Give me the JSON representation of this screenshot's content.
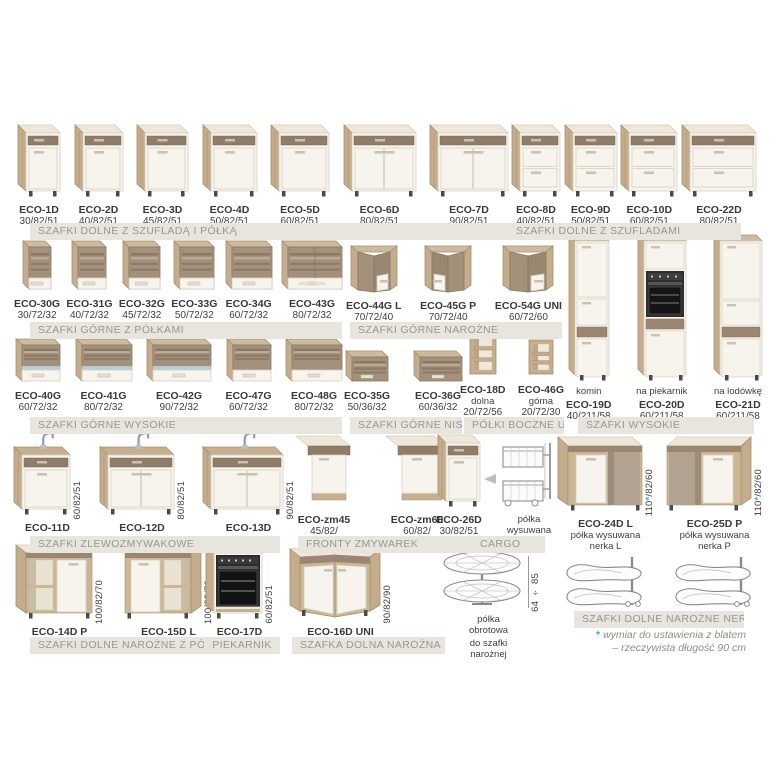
{
  "palette": {
    "wood": "#c4ad8c",
    "wood_dark": "#a68e6d",
    "rustic_front": "#a3917c",
    "white_front": "#f7f4ee",
    "counter": "#efe8da",
    "dark_strip": "#8f7c69",
    "bar_bg": "#e8e5df",
    "bar_text": "#98968e",
    "accent_blue": "#2fa8d5",
    "text": "#3a3a3a",
    "taupe": "#b2a292",
    "glass": "#b9cdd6"
  },
  "sections": [
    {
      "label": "SZAFKI DOLNE Z SZUFLADĄ I PÓŁKĄ",
      "products": [
        {
          "name": "ECO-1D",
          "dims": "30/82/51"
        },
        {
          "name": "ECO-2D",
          "dims": "40/82/51"
        },
        {
          "name": "ECO-3D",
          "dims": "45/82/51"
        },
        {
          "name": "ECO-4D",
          "dims": "50/82/51"
        },
        {
          "name": "ECO-5D",
          "dims": "60/82/51"
        },
        {
          "name": "ECO-6D",
          "dims": "80/82/51"
        },
        {
          "name": "ECO-7D",
          "dims": "90/82/51"
        }
      ]
    },
    {
      "label": "SZAFKI DOLNE Z SZUFLADAMI",
      "products": [
        {
          "name": "ECO-8D",
          "dims": "40/82/51"
        },
        {
          "name": "ECO-9D",
          "dims": "50/82/51"
        },
        {
          "name": "ECO-10D",
          "dims": "60/82/51"
        },
        {
          "name": "ECO-22D",
          "dims": "80/82/51"
        }
      ]
    },
    {
      "label": "SZAFKI GÓRNE Z PÓŁKAMI",
      "products": [
        {
          "name": "ECO-30G",
          "dims": "30/72/32"
        },
        {
          "name": "ECO-31G",
          "dims": "40/72/32"
        },
        {
          "name": "ECO-32G",
          "dims": "45/72/32"
        },
        {
          "name": "ECO-33G",
          "dims": "50/72/32"
        },
        {
          "name": "ECO-34G",
          "dims": "60/72/32"
        },
        {
          "name": "ECO-43G",
          "dims": "80/72/32"
        }
      ]
    },
    {
      "label": "SZAFKI GÓRNE NAROŻNE",
      "products": [
        {
          "name": "ECO-44G L",
          "dims": "70/72/40"
        },
        {
          "name": "ECO-45G P",
          "dims": "70/72/40"
        },
        {
          "name": "ECO-54G UNI",
          "dims": "60/72/60"
        }
      ]
    },
    {
      "label": "SZAFKI WYSOKIE",
      "products": [
        {
          "name": "ECO-19D",
          "dims": "40/211/58",
          "note": "komin"
        },
        {
          "name": "ECO-20D",
          "dims": "60/211/58",
          "note": "na piekarnik"
        },
        {
          "name": "ECO-21D",
          "dims": "60/211/58",
          "note": "na lodówkę"
        }
      ]
    },
    {
      "label": "SZAFKI GÓRNE WYSOKIE",
      "products": [
        {
          "name": "ECO-40G",
          "dims": "60/72/32"
        },
        {
          "name": "ECO-41G",
          "dims": "80/72/32"
        },
        {
          "name": "ECO-42G",
          "dims": "90/72/32"
        },
        {
          "name": "ECO-47G",
          "dims": "60/72/32"
        },
        {
          "name": "ECO-48G",
          "dims": "80/72/32"
        }
      ]
    },
    {
      "label": "SZAFKI GÓRNE NISKIE",
      "products": [
        {
          "name": "ECO-35G",
          "dims": "50/36/32"
        },
        {
          "name": "ECO-36G",
          "dims": "60/36/32"
        }
      ]
    },
    {
      "label": "PÓŁKI BOCZNE UNI",
      "products": [
        {
          "name": "ECO-18D",
          "note": "dolna",
          "dims": "20/72/56"
        },
        {
          "name": "ECO-46G",
          "note": "górna",
          "dims": "20/72/30"
        }
      ]
    },
    {
      "label": "SZAFKI ZLEWOZMYWAKOWE",
      "products": [
        {
          "name": "ECO-11D",
          "side_dims": "60/82/51"
        },
        {
          "name": "ECO-12D",
          "side_dims": "80/82/51"
        },
        {
          "name": "ECO-13D",
          "side_dims": "90/82/51"
        }
      ]
    },
    {
      "label": "FRONTY ZMYWAREK",
      "products": [
        {
          "name": "ECO-zm45",
          "dims": "45/82/"
        },
        {
          "name": "ECO-zm60",
          "dims": "60/82/"
        }
      ]
    },
    {
      "label": "CARGO",
      "products": [
        {
          "name": "ECO-26D",
          "dims": "30/82/51"
        },
        {
          "caption": "półka wysuwana"
        }
      ]
    },
    {
      "label": "SZAFKI DOLNE NAROŻNE NERKI",
      "products": [
        {
          "name": "ECO-24D L",
          "note": "półka wysuwana",
          "note2": "nerka L",
          "side_dims": "110*/82/60"
        },
        {
          "name": "ECO-25D P",
          "note": "półka wysuwana",
          "note2": "nerka P",
          "side_dims": "110*/82/60"
        }
      ]
    },
    {
      "label": "SZAFKI DOLNE NAROŻNE Z PÓŁKĄ",
      "products": [
        {
          "name": "ECO-14D P",
          "side_dims": "100/82/70"
        },
        {
          "name": "ECO-15D L",
          "side_dims": "100/82/70"
        }
      ]
    },
    {
      "label": "PIEKARNIK",
      "products": [
        {
          "name": "ECO-17D",
          "side_dims": "60/82/51"
        }
      ]
    },
    {
      "label": "SZAFKA DOLNA NAROŻNA",
      "products": [
        {
          "name": "ECO-16D UNI",
          "side_dims": "90/82/90"
        }
      ]
    },
    {
      "label": "",
      "products": [
        {
          "caption": "półka obrotowa",
          "caption2": "do szafki narożnej",
          "side_dims": "64 ÷ 85"
        }
      ]
    }
  ],
  "footnote": {
    "asterisk": "*",
    "line1": "wymiar do ustawienia z blatem",
    "line2": "– rzeczywista długość 90 cm"
  }
}
